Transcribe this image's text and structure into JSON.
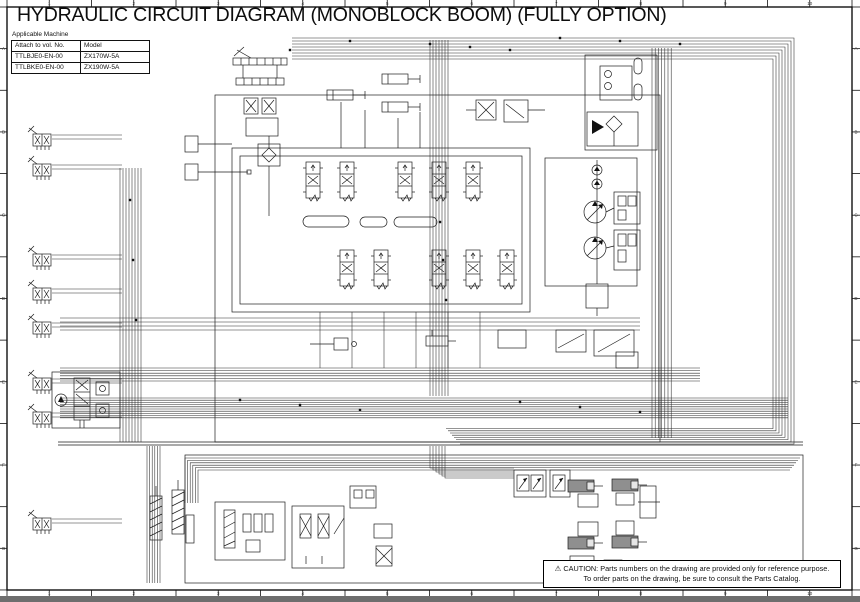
{
  "page": {
    "title": "HYDRAULIC CIRCUIT DIAGRAM (MONOBLOCK BOOM) (FULLY OPTION)"
  },
  "applicable_machine": {
    "caption": "Applicable Machine",
    "columns": [
      "Attach to vol. No.",
      "Model"
    ],
    "rows": [
      [
        "TTLBJE0-EN-00",
        "ZX170W-5A"
      ],
      [
        "TTLBKE0-EN-00",
        "ZX190W-5A"
      ]
    ]
  },
  "caution": {
    "warning_icon": "⚠",
    "line1": "CAUTION: Parts numbers on the drawing are provided only for reference purpose.",
    "line2": "To order parts on the drawing, be sure to consult the Parts Catalog."
  },
  "ruler": {
    "top": [
      "1",
      "2",
      "3",
      "4",
      "5",
      "6",
      "7",
      "8",
      "9",
      "10"
    ],
    "bottom": [
      "1",
      "2",
      "3",
      "4",
      "5",
      "6",
      "7",
      "8",
      "9",
      "10"
    ],
    "left": [
      "A",
      "B",
      "C",
      "D",
      "E",
      "F",
      "G"
    ],
    "right": [
      "A",
      "B",
      "C",
      "D",
      "E",
      "F",
      "G"
    ]
  },
  "colors": {
    "ink": "#1d1d1d",
    "scan_bar": "#6e6e6e",
    "cylinder_gray": "#8f8f8f"
  }
}
